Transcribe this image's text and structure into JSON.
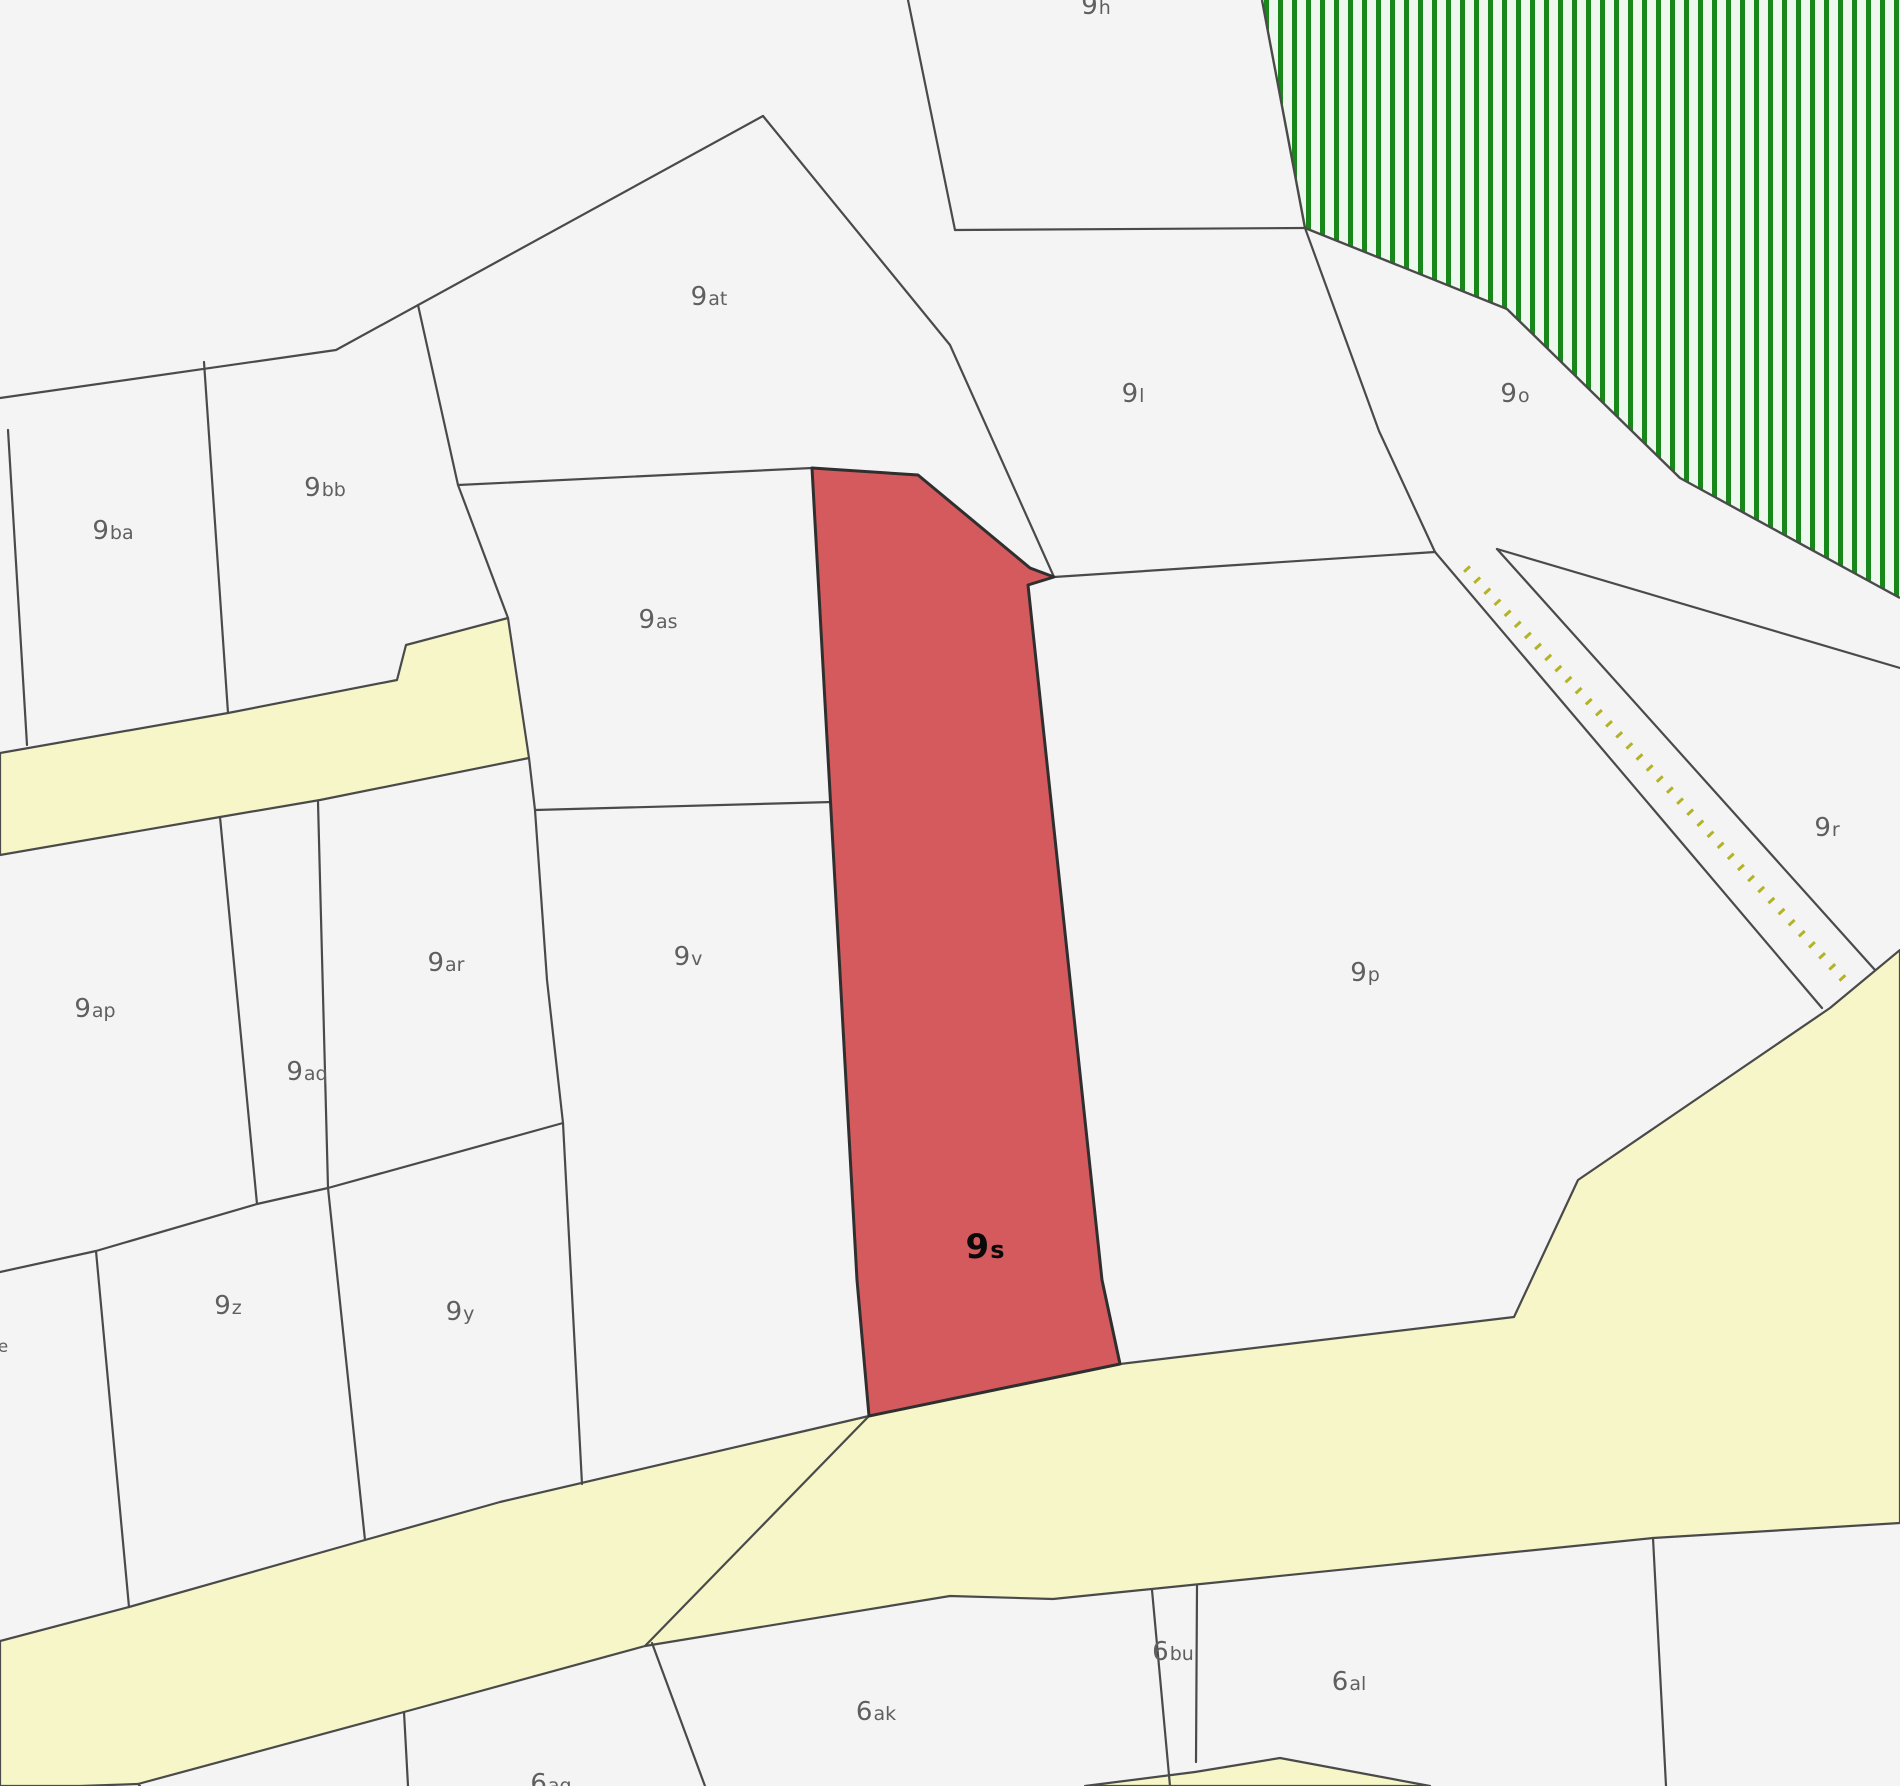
{
  "map": {
    "title": "cadastral-parcel-map",
    "width": 1900,
    "height": 1786,
    "colors": {
      "background": "#f4f4f4",
      "parcel_fill": "#f4f4f4",
      "boundary": "#4a4a4a",
      "road_fill": "#f6f6c8",
      "forest_stripe": "#18881b",
      "forest_bg": "#eef8ee",
      "highlight_fill": "#d45a5e",
      "highlight_stroke": "#2f2f2f",
      "path_dot": "#b3b328",
      "label": "#5f5f5f",
      "highlight_label": "#0a0a0a"
    },
    "forest": {
      "name": "forest-hatched-area",
      "points": "1262,0 1305,228 1507,309 1680,478 1900,598 1900,0",
      "edge": "1262,0 1305,228 1507,309 1680,478 1900,598",
      "stripe_period": 14,
      "stripe_width": 5
    },
    "roads": [
      {
        "name": "road-upper-left",
        "points": "0,753 228,713 397,680 406,645 508,618 529,758 320,800 220,817 0,855"
      },
      {
        "name": "road-lower",
        "points": "0,1641 129,1607 365,1540 500,1502 869,1416 1120,1364 1514,1317 1578,1180 1830,1008 1900,950 1900,1523 1653,1538 1053,1599 950,1596 645,1646 404,1712 138,1784 80,1786 0,1786"
      },
      {
        "name": "road-bottom-sliver",
        "points": "1085,1786 1195,1772 1280,1758 1430,1786"
      }
    ],
    "highlight_parcel": {
      "name": "parcel-9s-highlighted",
      "points": "812,468 918,475 1030,568 1054,577 1028,585 1102,1280 1120,1364 869,1416 857,1280"
    },
    "dotted_path": {
      "name": "dotted-track",
      "x1": 1466,
      "y1": 568,
      "x2": 1848,
      "y2": 984
    },
    "boundaries": [
      {
        "name": "boundary-9at-west",
        "points": "763,116 336,350 0,398"
      },
      {
        "name": "boundary-9ba-9bb",
        "points": "204,362 228,713"
      },
      {
        "name": "boundary-9ba-sliver",
        "points": "8,430 27,745"
      },
      {
        "name": "boundary-9bb-9as",
        "points": "418,305 458,485 508,618"
      },
      {
        "name": "boundary-9as-top",
        "points": "458,485 812,468"
      },
      {
        "name": "boundary-9as-9v",
        "points": "535,810 832,802"
      },
      {
        "name": "boundary-9v-west-chain",
        "points": "529,758 535,810 547,980 563,1123 582,1484"
      },
      {
        "name": "boundary-row-divider",
        "points": "0,1272 96,1251 257,1204 328,1188 563,1123"
      },
      {
        "name": "boundary-9ap-9aq",
        "points": "220,817 257,1204"
      },
      {
        "name": "boundary-9aq-9ar",
        "points": "318,802 328,1188"
      },
      {
        "name": "boundary-9z-west",
        "points": "96,1251 129,1607"
      },
      {
        "name": "boundary-9z-9y",
        "points": "328,1188 365,1540"
      },
      {
        "name": "boundary-9at-9l",
        "points": "763,116 950,345 1054,577"
      },
      {
        "name": "boundary-9h-west",
        "points": "908,0 955,230"
      },
      {
        "name": "boundary-9h-9l",
        "points": "955,230 1305,228"
      },
      {
        "name": "boundary-9l-9o",
        "points": "1305,228 1379,431 1435,552"
      },
      {
        "name": "boundary-9l-9p",
        "points": "1054,577 1435,552"
      },
      {
        "name": "boundary-corridor-left",
        "points": "1435,552 1822,1008"
      },
      {
        "name": "boundary-corridor-right",
        "points": "1497,549 1875,970"
      },
      {
        "name": "boundary-9o-9r",
        "points": "1497,549 1900,668"
      },
      {
        "name": "boundary-road-diagonal",
        "points": "869,1416 645,1646"
      },
      {
        "name": "boundary-6ag-6ak",
        "points": "652,1643 705,1786"
      },
      {
        "name": "boundary-6bu-west",
        "points": "1152,1590 1170,1786"
      },
      {
        "name": "boundary-6bu-east",
        "points": "1197,1586 1196,1762"
      },
      {
        "name": "boundary-6al-east",
        "points": "1653,1538 1666,1786"
      },
      {
        "name": "boundary-below-road-left",
        "points": "404,1712 408,1786"
      },
      {
        "name": "boundary-bottom-corner",
        "points": "138,1784 140,1786"
      }
    ],
    "labels": [
      {
        "name": "parcel-label-9h",
        "num": "9",
        "suffix": "h",
        "x": 1096,
        "y": 14,
        "style": "normal"
      },
      {
        "name": "parcel-label-9at",
        "num": "9",
        "suffix": "at",
        "x": 709,
        "y": 305,
        "style": "normal"
      },
      {
        "name": "parcel-label-9l",
        "num": "9",
        "suffix": "l",
        "x": 1133,
        "y": 402,
        "style": "normal"
      },
      {
        "name": "parcel-label-9o",
        "num": "9",
        "suffix": "o",
        "x": 1515,
        "y": 402,
        "style": "normal"
      },
      {
        "name": "parcel-label-9bb",
        "num": "9",
        "suffix": "bb",
        "x": 325,
        "y": 496,
        "style": "normal"
      },
      {
        "name": "parcel-label-9ba",
        "num": "9",
        "suffix": "ba",
        "x": 113,
        "y": 539,
        "style": "normal"
      },
      {
        "name": "parcel-label-9as",
        "num": "9",
        "suffix": "as",
        "x": 658,
        "y": 628,
        "style": "normal"
      },
      {
        "name": "parcel-label-9r",
        "num": "9",
        "suffix": "r",
        "x": 1827,
        "y": 836,
        "style": "normal"
      },
      {
        "name": "parcel-label-9ar",
        "num": "9",
        "suffix": "ar",
        "x": 446,
        "y": 971,
        "style": "normal"
      },
      {
        "name": "parcel-label-9v",
        "num": "9",
        "suffix": "v",
        "x": 688,
        "y": 965,
        "style": "normal"
      },
      {
        "name": "parcel-label-9p",
        "num": "9",
        "suffix": "p",
        "x": 1365,
        "y": 981,
        "style": "normal"
      },
      {
        "name": "parcel-label-9ap",
        "num": "9",
        "suffix": "ap",
        "x": 95,
        "y": 1017,
        "style": "normal"
      },
      {
        "name": "parcel-label-9aq",
        "num": "9",
        "suffix": "aq",
        "x": 307,
        "y": 1080,
        "style": "normal"
      },
      {
        "name": "parcel-label-9s",
        "num": "9",
        "suffix": "s",
        "x": 985,
        "y": 1258,
        "style": "highlight"
      },
      {
        "name": "parcel-label-9z",
        "num": "9",
        "suffix": "z",
        "x": 228,
        "y": 1314,
        "style": "normal"
      },
      {
        "name": "parcel-label-9y",
        "num": "9",
        "suffix": "y",
        "x": 460,
        "y": 1320,
        "style": "normal"
      },
      {
        "name": "parcel-label-e-partial",
        "num": "",
        "suffix": "e",
        "x": 3,
        "y": 1352,
        "style": "partial"
      },
      {
        "name": "parcel-label-6bu",
        "num": "6",
        "suffix": "bu",
        "x": 1173,
        "y": 1660,
        "style": "normal"
      },
      {
        "name": "parcel-label-6al",
        "num": "6",
        "suffix": "al",
        "x": 1349,
        "y": 1690,
        "style": "normal"
      },
      {
        "name": "parcel-label-6ak",
        "num": "6",
        "suffix": "ak",
        "x": 876,
        "y": 1720,
        "style": "normal"
      },
      {
        "name": "parcel-label-6ag",
        "num": "6",
        "suffix": "ag",
        "x": 551,
        "y": 1792,
        "style": "normal"
      }
    ]
  }
}
